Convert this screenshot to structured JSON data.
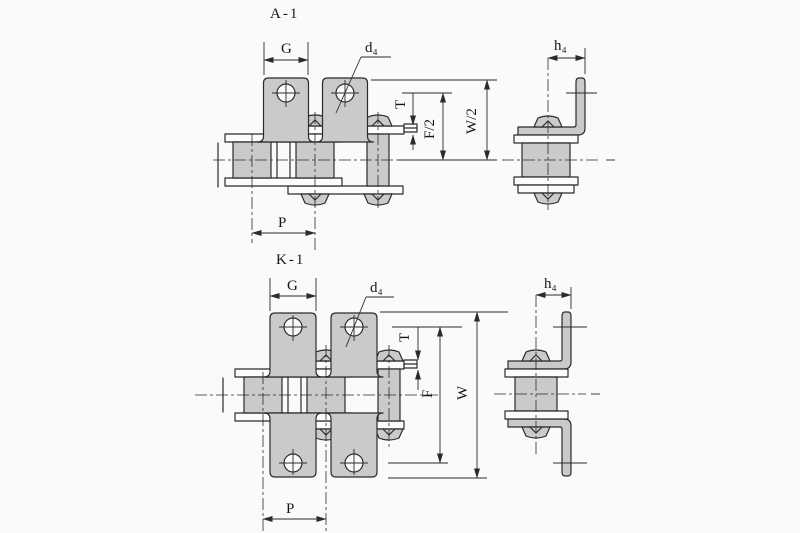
{
  "drawing": {
    "type": "roller-chain-attachment-technical-drawing",
    "titles": {
      "a1": "A-1",
      "k1": "K-1"
    },
    "labels": {
      "g": "G",
      "d4": "d₄",
      "h4": "h₄",
      "t": "T",
      "f_half": "F/2",
      "w_half": "W/2",
      "p": "P",
      "f": "F",
      "w": "W"
    },
    "colors": {
      "line": "#2b2b2b",
      "part_fill": "#c9cbca",
      "background": "#fbfaf8"
    }
  }
}
